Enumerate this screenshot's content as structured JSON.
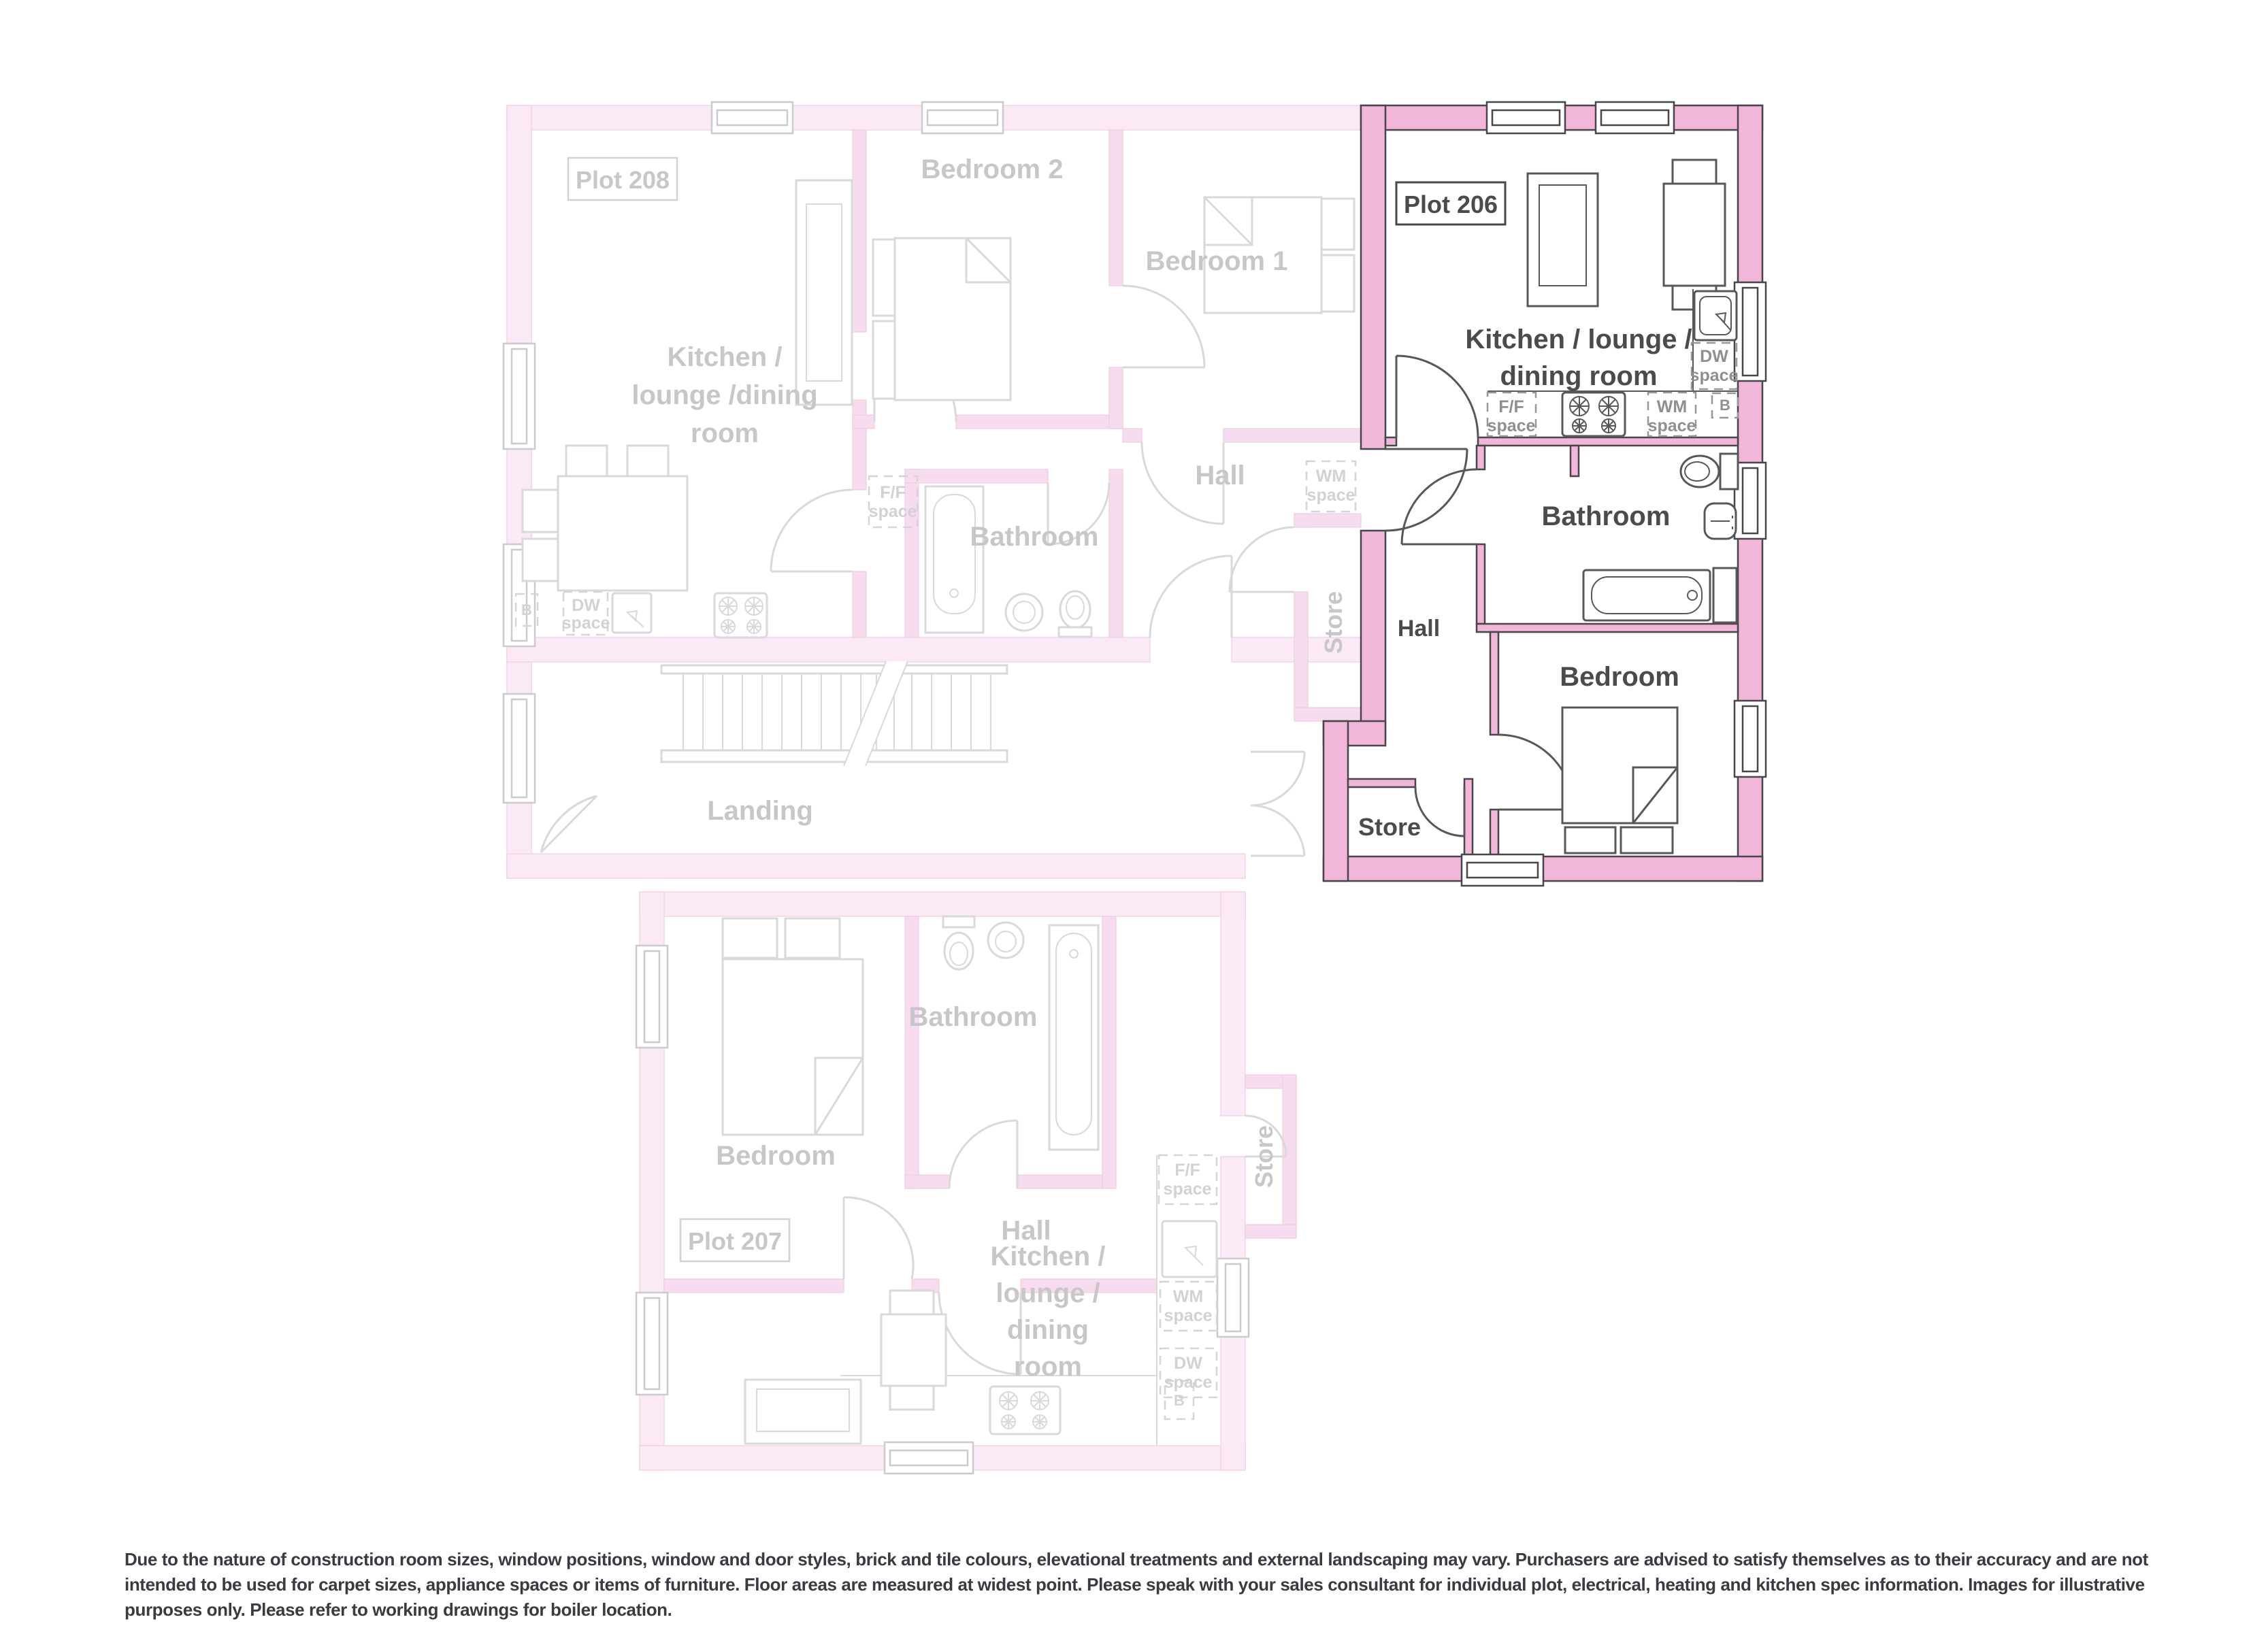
{
  "landing": {
    "label": "Landing"
  },
  "plot208": {
    "label": "Plot 208",
    "kitchen": {
      "lines": [
        "Kitchen /",
        "lounge /dining",
        "room"
      ]
    },
    "bedroom2": "Bedroom 2",
    "bedroom1": "Bedroom 1",
    "hall": "Hall",
    "bathroom": "Bathroom",
    "store": "Store",
    "ff": {
      "l1": "F/F",
      "l2": "space"
    },
    "wm": {
      "l1": "WM",
      "l2": "space"
    },
    "dw": {
      "l1": "DW",
      "l2": "space"
    },
    "boiler": "B"
  },
  "plot206": {
    "label": "Plot 206",
    "kitchen": {
      "lines": [
        "Kitchen / lounge /",
        "dining room"
      ]
    },
    "bathroom": "Bathroom",
    "hall": "Hall",
    "bedroom": "Bedroom",
    "store": "Store",
    "ff": {
      "l1": "F/F",
      "l2": "space"
    },
    "wm": {
      "l1": "WM",
      "l2": "space"
    },
    "dw": {
      "l1": "DW",
      "l2": "space"
    },
    "boiler": "B"
  },
  "plot207": {
    "label": "Plot 207",
    "bedroom": "Bedroom",
    "bathroom": "Bathroom",
    "hall": "Hall",
    "store": "Store",
    "kitchen": {
      "lines": [
        "Kitchen /",
        "lounge /",
        "dining",
        "room"
      ]
    },
    "ff": {
      "l1": "F/F",
      "l2": "space"
    },
    "wm": {
      "l1": "WM",
      "l2": "space"
    },
    "dw": {
      "l1": "DW",
      "l2": "space"
    },
    "boiler": "B"
  },
  "disclaimer": "Due to the nature of construction room sizes, window positions, window and door styles, brick and tile colours, elevational treatments and external landscaping may vary. Purchasers are advised to satisfy themselves as to their accuracy and are not intended to be used for carpet sizes, appliance spaces or items of furniture. Floor areas are measured at widest point. Please speak with your sales consultant for individual plot, electrical, heating and kitchen spec information. Images for illustrative purposes only. Please refer to working drawings for boiler location.",
  "colors": {
    "highlight_wall": "#f1b6d9",
    "highlight_outline": "#47474a",
    "faded_wall": "#fbe9f5",
    "faded_partition": "#f6dcee",
    "faded_line": "#d9d8db",
    "faded_text": "#c7c6c9",
    "dark_text": "#4b4b4e",
    "appliance_text": "#8f8e93",
    "disclaimer_text": "#3a3a40"
  }
}
